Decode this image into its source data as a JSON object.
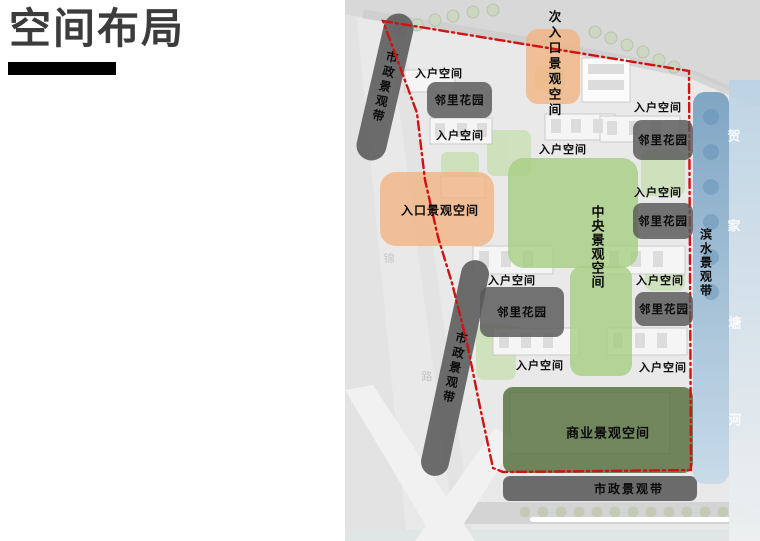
{
  "slide": {
    "title": "空间布局"
  },
  "map": {
    "labels": {
      "entry_space": "入户空间",
      "neighborhood_garden": "邻里花园",
      "central_landscape_space": "中央景观空间",
      "commercial_landscape_space": "商业景观空间",
      "municipal_landscape_belt": "市政景观带",
      "waterfront_landscape_belt": "滨水景观带",
      "entrance_landscape_space": "入口景观空间",
      "secondary_entrance_landscape_space": "次入口景观空间"
    },
    "street_chars": [
      "龙",
      "锦",
      "路"
    ],
    "river_name": "贺家塘河",
    "river_chars": [
      "贺",
      "家",
      "塘",
      "河"
    ],
    "colors": {
      "boundary_red": "#cf1212",
      "central_green": "#aed187",
      "commercial_green": "#6f8f5d",
      "municipal_gray": "#6c6c6c",
      "waterfront_blue": "#86add0",
      "river_blue": "#c9dbe7",
      "entrance_orange": "#f3b988",
      "garden_box_gray": "#5f5f5f",
      "title_black": "#3c3c3c"
    }
  }
}
